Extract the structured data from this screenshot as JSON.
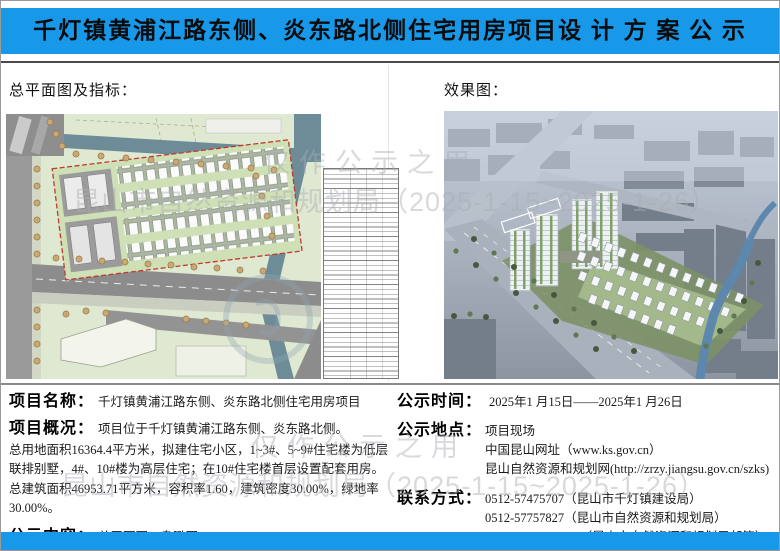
{
  "title": "千灯镇黄浦江路东侧、炎东路北侧住宅用房项目设 计 方 案 公 示",
  "sections": {
    "site_plan_label": "总平面图及指标：",
    "rendering_label": "效果图："
  },
  "watermark": {
    "line1": "仅作公示之用",
    "line2": "昆山市自然资源和规划局（2025-1-15~2025-1-26）"
  },
  "project": {
    "name_label": "项目名称：",
    "name": "千灯镇黄浦江路东侧、炎东路北侧住宅用房项目",
    "overview_label": "项目概况：",
    "overview_intro": "项目位于千灯镇黄浦江路东侧、炎东路北侧。",
    "overview_detail": "总用地面积16364.4平方米，拟建住宅小区，1~3#、5~9#住宅楼为低层联排别墅，4#、10#楼为高层住宅；在10#住宅楼首层设置配套用房。总建筑面积46953.71平方米，容积率1.60，建筑密度30.00%，绿地率30.00%。",
    "content_label": "公示内容：",
    "content": "总平面图、鸟瞰图"
  },
  "notice": {
    "time_label": "公示时间：",
    "time": "2025年1 月15日——2025年1 月26日",
    "location_label": "公示地点：",
    "locations": [
      "项目现场",
      "中国昆山网址（www.ks.gov.cn）",
      "昆山自然资源和规划网(http://zrzy.jiangsu.gov.cn/szks)"
    ],
    "contact_label": "联系方式：",
    "contacts": [
      "0512-57475707（昆山市千灯镇建设局）",
      "0512-57757827（昆山市自然资源和规划局）",
      "ksup@ksup.gov.cn（昆山市自然资源和规划局邮箱）"
    ]
  },
  "colors": {
    "banner_blue": "#1798e9"
  }
}
